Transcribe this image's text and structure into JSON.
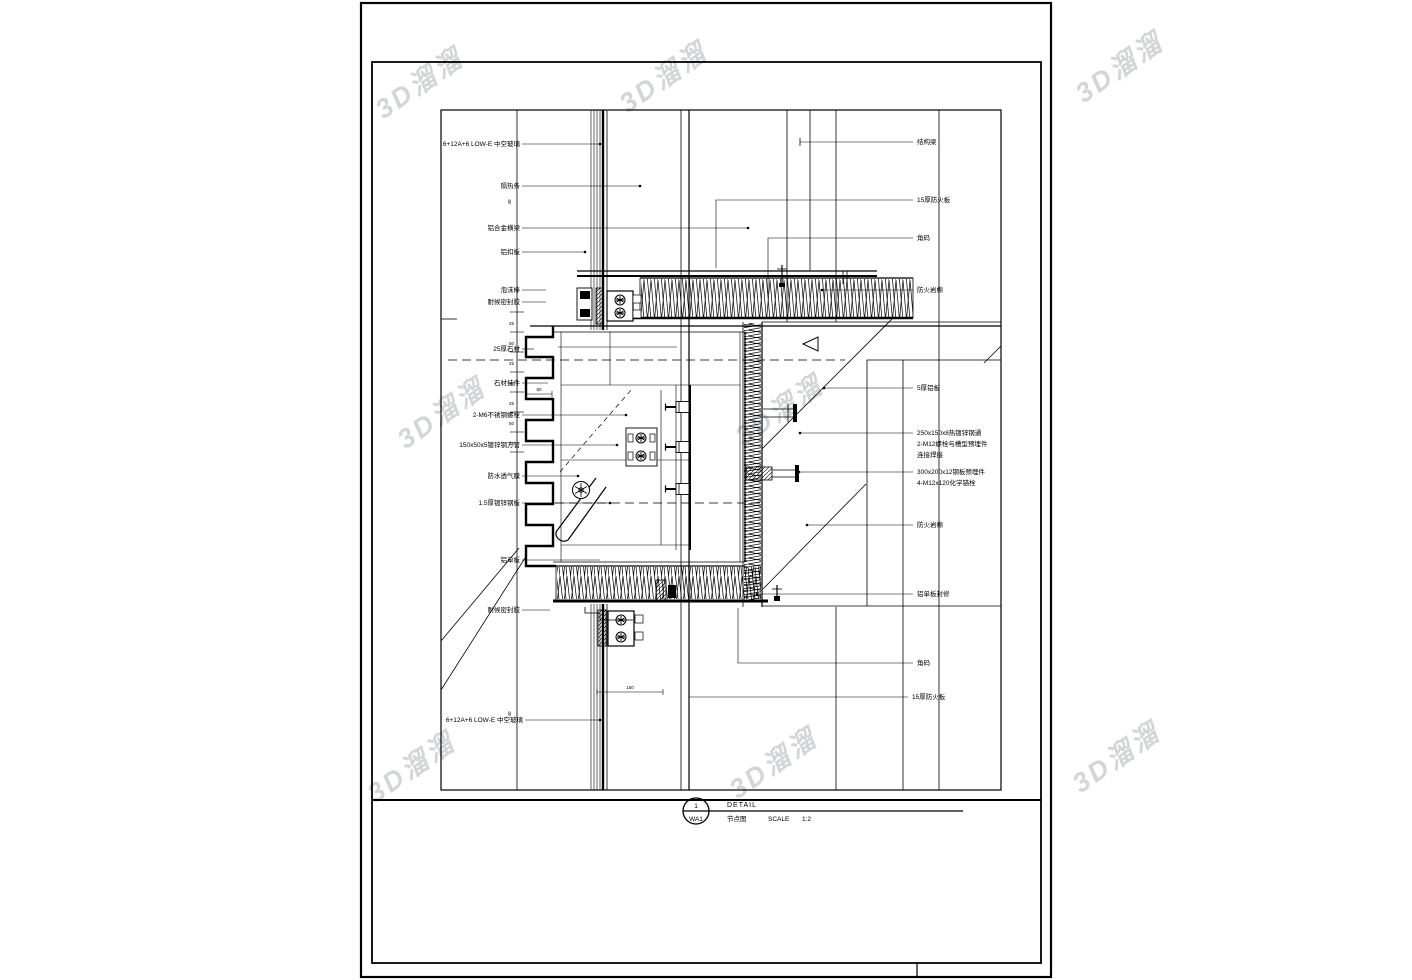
{
  "watermark": {
    "text": "3D溜溜"
  },
  "drawing": {
    "title_block": {
      "bubble_top": "1",
      "bubble_bottom": "WA1",
      "detail_label": "DETAIL",
      "detail_name": "节点图",
      "scale_label": "SCALE",
      "scale_value": "1:2"
    },
    "labels": {
      "left": [
        "6+12A+6 LOW-E 中空玻璃",
        "隔热条",
        "铝合金横梁",
        "铝扣板",
        "泡沫棒",
        "耐候密封胶",
        "25厚石材",
        "石材挂件",
        "2-M6不锈钢螺栓",
        "150x50x5镀锌钢方管",
        "防水透气膜",
        "1.5厚镀锌钢板",
        "铝单板",
        "耐候密封胶",
        "6+12A+6 LOW-E 中空玻璃"
      ],
      "right": [
        "结构梁",
        "15厚防火板",
        "角码",
        "防火岩棉",
        "5厚铝板",
        [
          "250x150x8热镀锌钢通",
          "2-M12螺栓与槽型预埋件",
          "连接焊接"
        ],
        [
          "300x200x12钢板预埋件",
          "4-M12x120化学锚栓"
        ],
        "防火岩棉",
        "铝单板封修",
        "角码",
        "15厚防火板"
      ]
    },
    "dimensions": {
      "ladder": [
        "25",
        "50",
        "25",
        "50",
        "25",
        "50",
        "25"
      ],
      "d50": "50",
      "d150": "150",
      "d40_top": "40",
      "d40_bottom": "40"
    }
  }
}
